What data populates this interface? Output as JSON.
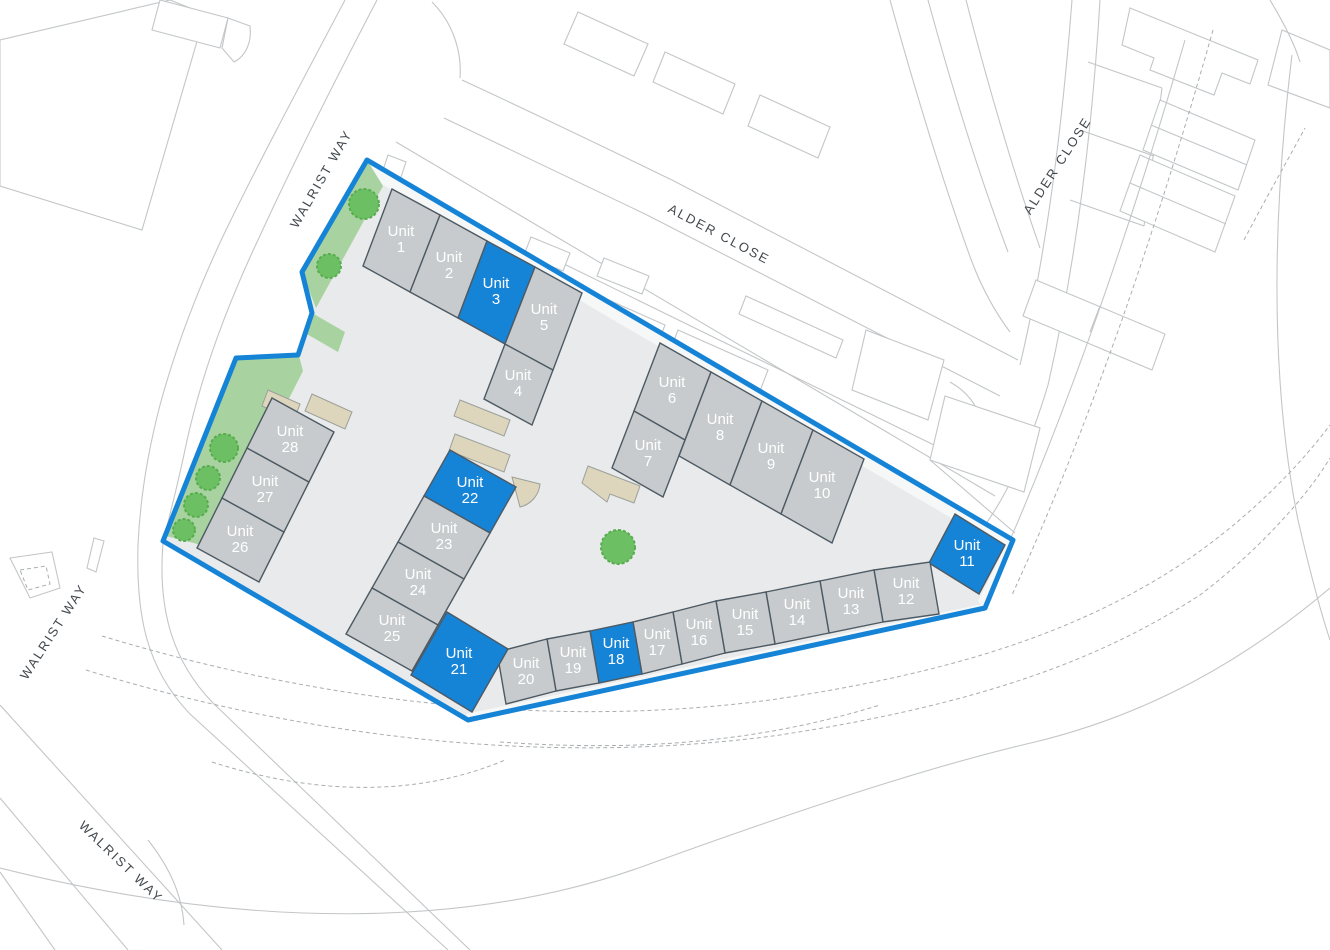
{
  "map": {
    "title": "Industrial estate site plan",
    "streets": [
      {
        "id": "walrist-way-top",
        "label": "WALRIST WAY"
      },
      {
        "id": "alder-close-top",
        "label": "ALDER CLOSE"
      },
      {
        "id": "alder-close-right",
        "label": "ALDER CLOSE"
      },
      {
        "id": "walrist-way-left",
        "label": "WALRIST WAY"
      },
      {
        "id": "walrist-way-bottom",
        "label": "WALRIST WAY"
      }
    ],
    "units": [
      {
        "word": "Unit",
        "number": "1",
        "label": "Unit 1",
        "status": "standard"
      },
      {
        "word": "Unit",
        "number": "2",
        "label": "Unit 2",
        "status": "standard"
      },
      {
        "word": "Unit",
        "number": "3",
        "label": "Unit 3",
        "status": "highlighted"
      },
      {
        "word": "Unit",
        "number": "4",
        "label": "Unit 4",
        "status": "standard"
      },
      {
        "word": "Unit",
        "number": "5",
        "label": "Unit 5",
        "status": "standard"
      },
      {
        "word": "Unit",
        "number": "6",
        "label": "Unit 6",
        "status": "standard"
      },
      {
        "word": "Unit",
        "number": "7",
        "label": "Unit 7",
        "status": "standard"
      },
      {
        "word": "Unit",
        "number": "8",
        "label": "Unit 8",
        "status": "standard"
      },
      {
        "word": "Unit",
        "number": "9",
        "label": "Unit 9",
        "status": "standard"
      },
      {
        "word": "Unit",
        "number": "10",
        "label": "Unit 10",
        "status": "standard"
      },
      {
        "word": "Unit",
        "number": "11",
        "label": "Unit 11",
        "status": "highlighted"
      },
      {
        "word": "Unit",
        "number": "12",
        "label": "Unit 12",
        "status": "standard"
      },
      {
        "word": "Unit",
        "number": "13",
        "label": "Unit 13",
        "status": "standard"
      },
      {
        "word": "Unit",
        "number": "14",
        "label": "Unit 14",
        "status": "standard"
      },
      {
        "word": "Unit",
        "number": "15",
        "label": "Unit 15",
        "status": "standard"
      },
      {
        "word": "Unit",
        "number": "16",
        "label": "Unit 16",
        "status": "standard"
      },
      {
        "word": "Unit",
        "number": "17",
        "label": "Unit 17",
        "status": "standard"
      },
      {
        "word": "Unit",
        "number": "18",
        "label": "Unit 18",
        "status": "highlighted"
      },
      {
        "word": "Unit",
        "number": "19",
        "label": "Unit 19",
        "status": "standard"
      },
      {
        "word": "Unit",
        "number": "20",
        "label": "Unit 20",
        "status": "standard"
      },
      {
        "word": "Unit",
        "number": "21",
        "label": "Unit 21",
        "status": "highlighted"
      },
      {
        "word": "Unit",
        "number": "22",
        "label": "Unit 22",
        "status": "highlighted"
      },
      {
        "word": "Unit",
        "number": "23",
        "label": "Unit 23",
        "status": "standard"
      },
      {
        "word": "Unit",
        "number": "24",
        "label": "Unit 24",
        "status": "standard"
      },
      {
        "word": "Unit",
        "number": "25",
        "label": "Unit 25",
        "status": "standard"
      },
      {
        "word": "Unit",
        "number": "26",
        "label": "Unit 26",
        "status": "standard"
      },
      {
        "word": "Unit",
        "number": "27",
        "label": "Unit 27",
        "status": "standard"
      },
      {
        "word": "Unit",
        "number": "28",
        "label": "Unit 28",
        "status": "standard"
      }
    ],
    "colors": {
      "unit_default": "#c7cbcd",
      "unit_highlight": "#1583d6",
      "unit_stroke": "#4d5a63",
      "boundary": "#1583d6",
      "hardstanding": "#e9eaeb",
      "landscaping": "#a8d3a0",
      "tree": "#6cbf62",
      "loading_bay": "#ded5bd",
      "context_line": "#c3c6c8",
      "street_text": "#43484d"
    }
  }
}
